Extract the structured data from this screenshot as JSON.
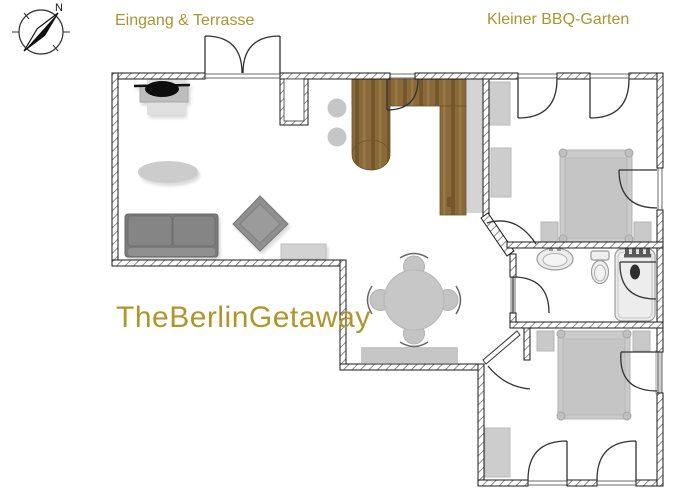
{
  "labels": {
    "terrace": "Eingang & Terrasse",
    "garden": "Kleiner BBQ-Garten",
    "brand": "TheBerlinGetaway",
    "north": "N"
  },
  "colors": {
    "label_olive": "#ab9430",
    "brand_gold": "#b2952a",
    "wall_line": "#1a1a1a",
    "hatch_line": "#6e6e6e",
    "wood": "#8a6a38",
    "wood_dark": "#74572a",
    "furniture_light": "#c9c9c9",
    "furniture_mid": "#9a9a9a",
    "furniture_dark": "#7d7d7d",
    "fixture_fill": "#ededed",
    "needle_black": "#111111"
  },
  "icons": {
    "compass": "compass-north-arrow-icon",
    "plan_items": [
      "tv-icon",
      "tv-lowboard",
      "rug",
      "sofa",
      "armchair",
      "sideboard",
      "kitchen-counter",
      "bar-stool",
      "swing-door",
      "double-entrance-door",
      "dining-table",
      "dining-chair",
      "dining-sideboard",
      "double-bed",
      "nightstand",
      "wardrobe",
      "washbasin",
      "toilet",
      "shower",
      "towel-radiator"
    ]
  }
}
